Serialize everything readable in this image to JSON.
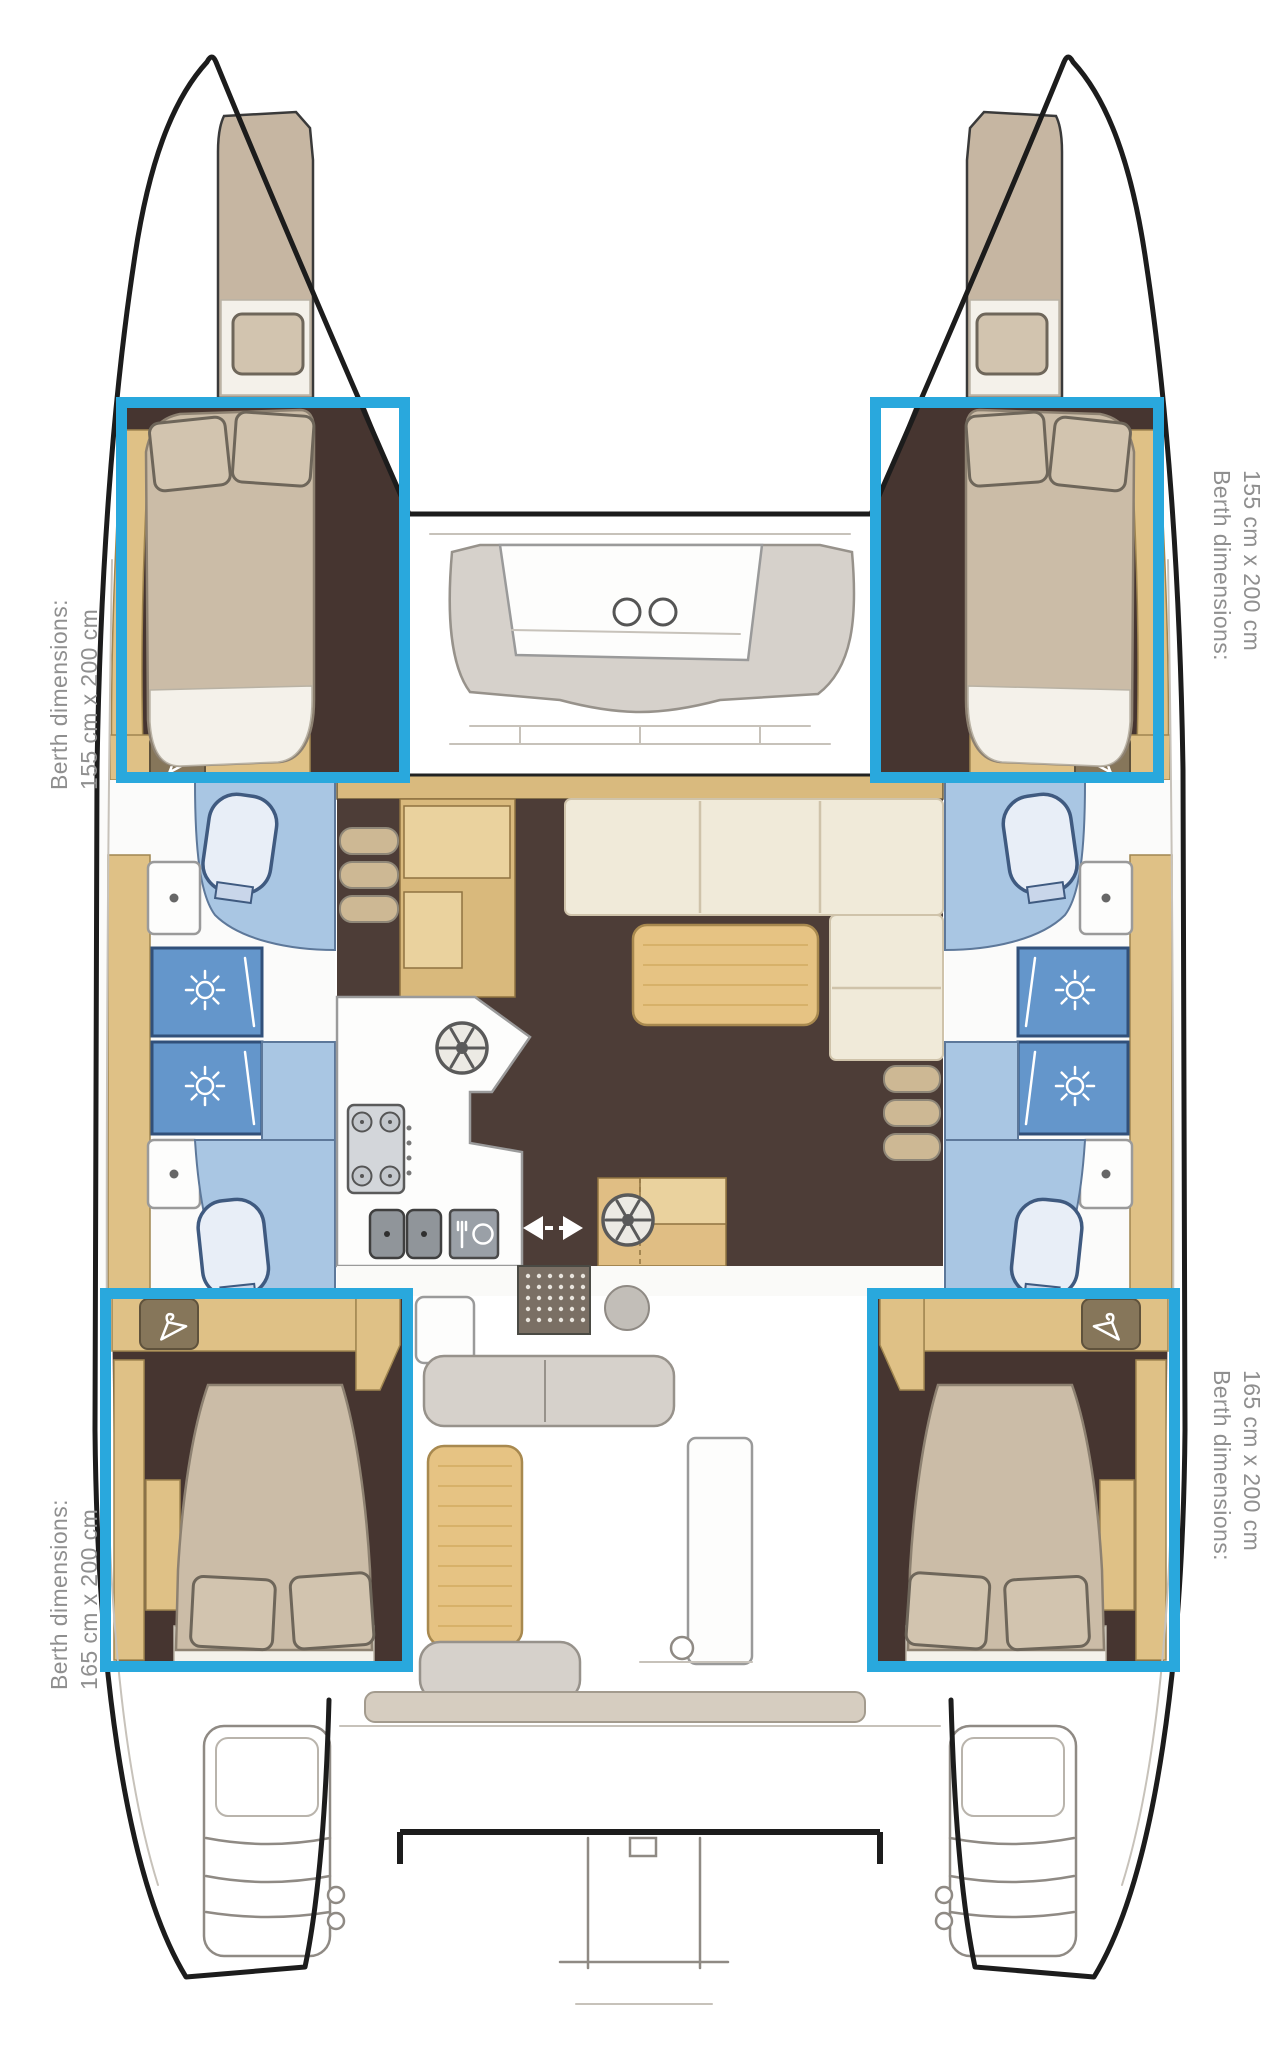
{
  "page": {
    "title": "Catamaran interior layout floor plan",
    "background": "#ffffff"
  },
  "highlight": {
    "color": "#29a8dd",
    "border_px": 11
  },
  "berths": [
    {
      "id": "forward-port",
      "label_line1": "Berth dimensions:",
      "label_line2": "155 cm x 200 cm"
    },
    {
      "id": "forward-starboard",
      "label_line1": "Berth dimensions:",
      "label_line2": "155 cm x 200 cm"
    },
    {
      "id": "aft-port",
      "label_line1": "Berth dimensions:",
      "label_line2": "165 cm x 200 cm"
    },
    {
      "id": "aft-starboard",
      "label_line1": "Berth dimensions:",
      "label_line2": "165 cm x 200 cm"
    }
  ],
  "icons": {
    "wardrobe": "hanger-icon",
    "shower": "sunburst-icon",
    "galley_sink": "wheel-icon",
    "nav_station": "wheel-icon",
    "stove": "four-burner-icon",
    "dishwasher": "fork-plate-icon",
    "sliding_door": "double-arrow-icon",
    "entry_mat": "dot-grid",
    "forward_table": "cup-holder-circles"
  },
  "colors": {
    "hull_outline": "#1c1c1c",
    "wood": "#dfc186",
    "salon_floor": "#4d3d37",
    "cabin_floor": "#463530",
    "mattress": "#cbbca7",
    "sofa": "#f0ead9",
    "bathroom_blue": "#a9c6e3",
    "shower_blue": "#6496cb",
    "label_text": "#8f8f8f"
  }
}
